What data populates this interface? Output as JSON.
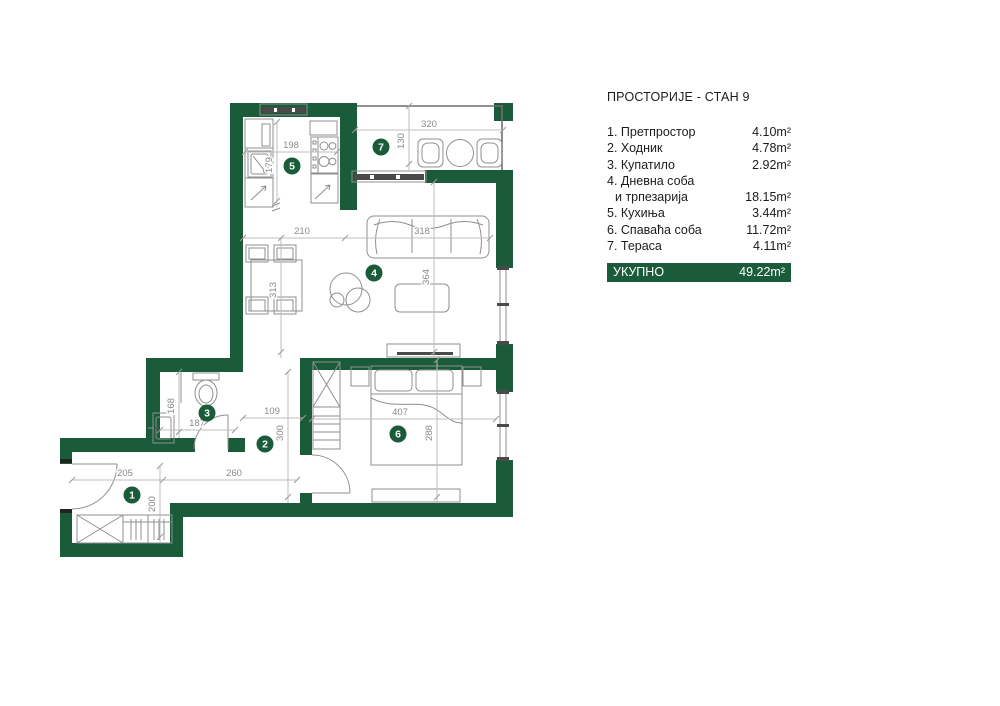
{
  "legend": {
    "title": "ПРОСТОРИЈЕ - СТАН 9",
    "rooms": [
      {
        "num": "1.",
        "name": "Претпростор",
        "area": "4.10m²"
      },
      {
        "num": "2.",
        "name": "Ходник",
        "area": "4.78m²"
      },
      {
        "num": "3.",
        "name": "Купатило",
        "area": "2.92m²"
      },
      {
        "num": "4.",
        "name": "Дневна соба",
        "name_line2": "и трпезарија",
        "area": "18.15m²"
      },
      {
        "num": "5.",
        "name": "Кухиња",
        "area": "3.44m²"
      },
      {
        "num": "6.",
        "name": "Спаваћа соба",
        "area": "11.72m²"
      },
      {
        "num": "7.",
        "name": "Тераса",
        "area": "4.11m²"
      }
    ],
    "total_label": "УКУПНО",
    "total_area": "49.22m²"
  },
  "colors": {
    "wall_green": "#1a5c39",
    "dimension_text": "#8a8a8a"
  },
  "plan": {
    "room_markers": [
      {
        "num": "1",
        "x": 132,
        "y": 495
      },
      {
        "num": "2",
        "x": 265,
        "y": 444
      },
      {
        "num": "3",
        "x": 207,
        "y": 413
      },
      {
        "num": "4",
        "x": 374,
        "y": 273
      },
      {
        "num": "5",
        "x": 292,
        "y": 166
      },
      {
        "num": "6",
        "x": 398,
        "y": 434
      },
      {
        "num": "7",
        "x": 381,
        "y": 147
      }
    ],
    "dimensions": [
      {
        "text": "198",
        "x": 291,
        "y": 148,
        "rot": 0
      },
      {
        "text": "179",
        "x": 272,
        "y": 165,
        "rot": -90
      },
      {
        "text": "320",
        "x": 429,
        "y": 127,
        "rot": 0
      },
      {
        "text": "130",
        "x": 404,
        "y": 141,
        "rot": -90
      },
      {
        "text": "210",
        "x": 302,
        "y": 234,
        "rot": 0
      },
      {
        "text": "318",
        "x": 422,
        "y": 234,
        "rot": 0
      },
      {
        "text": "364",
        "x": 429,
        "y": 277,
        "rot": -90
      },
      {
        "text": "313",
        "x": 276,
        "y": 290,
        "rot": -90
      },
      {
        "text": "109",
        "x": 272,
        "y": 414,
        "rot": 0
      },
      {
        "text": "300",
        "x": 283,
        "y": 433,
        "rot": -90
      },
      {
        "text": "187",
        "x": 197,
        "y": 426,
        "rot": 0
      },
      {
        "text": "168",
        "x": 174,
        "y": 406,
        "rot": -90
      },
      {
        "text": "407",
        "x": 400,
        "y": 415,
        "rot": 0
      },
      {
        "text": "288",
        "x": 432,
        "y": 433,
        "rot": -90
      },
      {
        "text": "205",
        "x": 125,
        "y": 476,
        "rot": 0
      },
      {
        "text": "260",
        "x": 234,
        "y": 476,
        "rot": 0
      },
      {
        "text": "200",
        "x": 155,
        "y": 504,
        "rot": -90
      }
    ]
  }
}
